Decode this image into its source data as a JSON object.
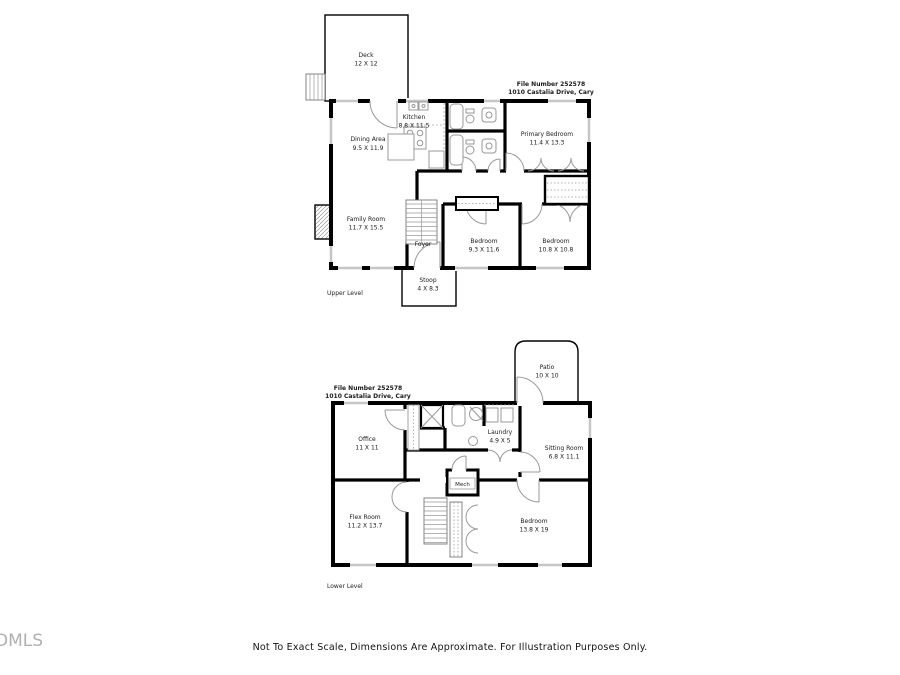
{
  "branding": {
    "logo_text": "DMLS"
  },
  "footer": {
    "disclaimer": "Not To Exact Scale, Dimensions Are Approximate. For Illustration Purposes Only."
  },
  "upper_level": {
    "level_label": "Upper Level",
    "file_number": "File Number 252578",
    "address": "1010 Castalia Drive, Cary",
    "rooms": {
      "deck": {
        "name": "Deck",
        "dims": "12 X 12"
      },
      "dining_area": {
        "name": "Dining Area",
        "dims": "9.5 X 11.9"
      },
      "kitchen": {
        "name": "Kitchen",
        "dims": "8.8 X 11.5"
      },
      "primary_bedroom": {
        "name": "Primary Bedroom",
        "dims": "11.4 X 13.3"
      },
      "family_room": {
        "name": "Family Room",
        "dims": "11.7 X 15.5"
      },
      "foyer": {
        "name": "Foyer"
      },
      "bedroom_1": {
        "name": "Bedroom",
        "dims": "9.3 X 11.6"
      },
      "bedroom_2": {
        "name": "Bedroom",
        "dims": "10.8 X 10.8"
      },
      "stoop": {
        "name": "Stoop",
        "dims": "4 X 8.3"
      }
    }
  },
  "lower_level": {
    "level_label": "Lower Level",
    "file_number": "File Number 252578",
    "address": "1010 Castalia Drive, Cary",
    "rooms": {
      "patio": {
        "name": "Patio",
        "dims": "10 X 10"
      },
      "office": {
        "name": "Office",
        "dims": "11 X 11"
      },
      "laundry": {
        "name": "Laundry",
        "dims": "4.9 X 5"
      },
      "sitting_room": {
        "name": "Sitting Room",
        "dims": "6.8 X 11.1"
      },
      "flex_room": {
        "name": "Flex Room",
        "dims": "11.2 X 13.7"
      },
      "mech": {
        "name": "Mech"
      },
      "bedroom": {
        "name": "Bedroom",
        "dims": "13.8 X 19"
      }
    }
  },
  "colors": {
    "wall": "#000000",
    "door_swing": "#9a9a9a",
    "window": "#c6c6c6",
    "label_text": "#1a1a1a",
    "logo": "#b0b0b0",
    "background": "#ffffff"
  }
}
